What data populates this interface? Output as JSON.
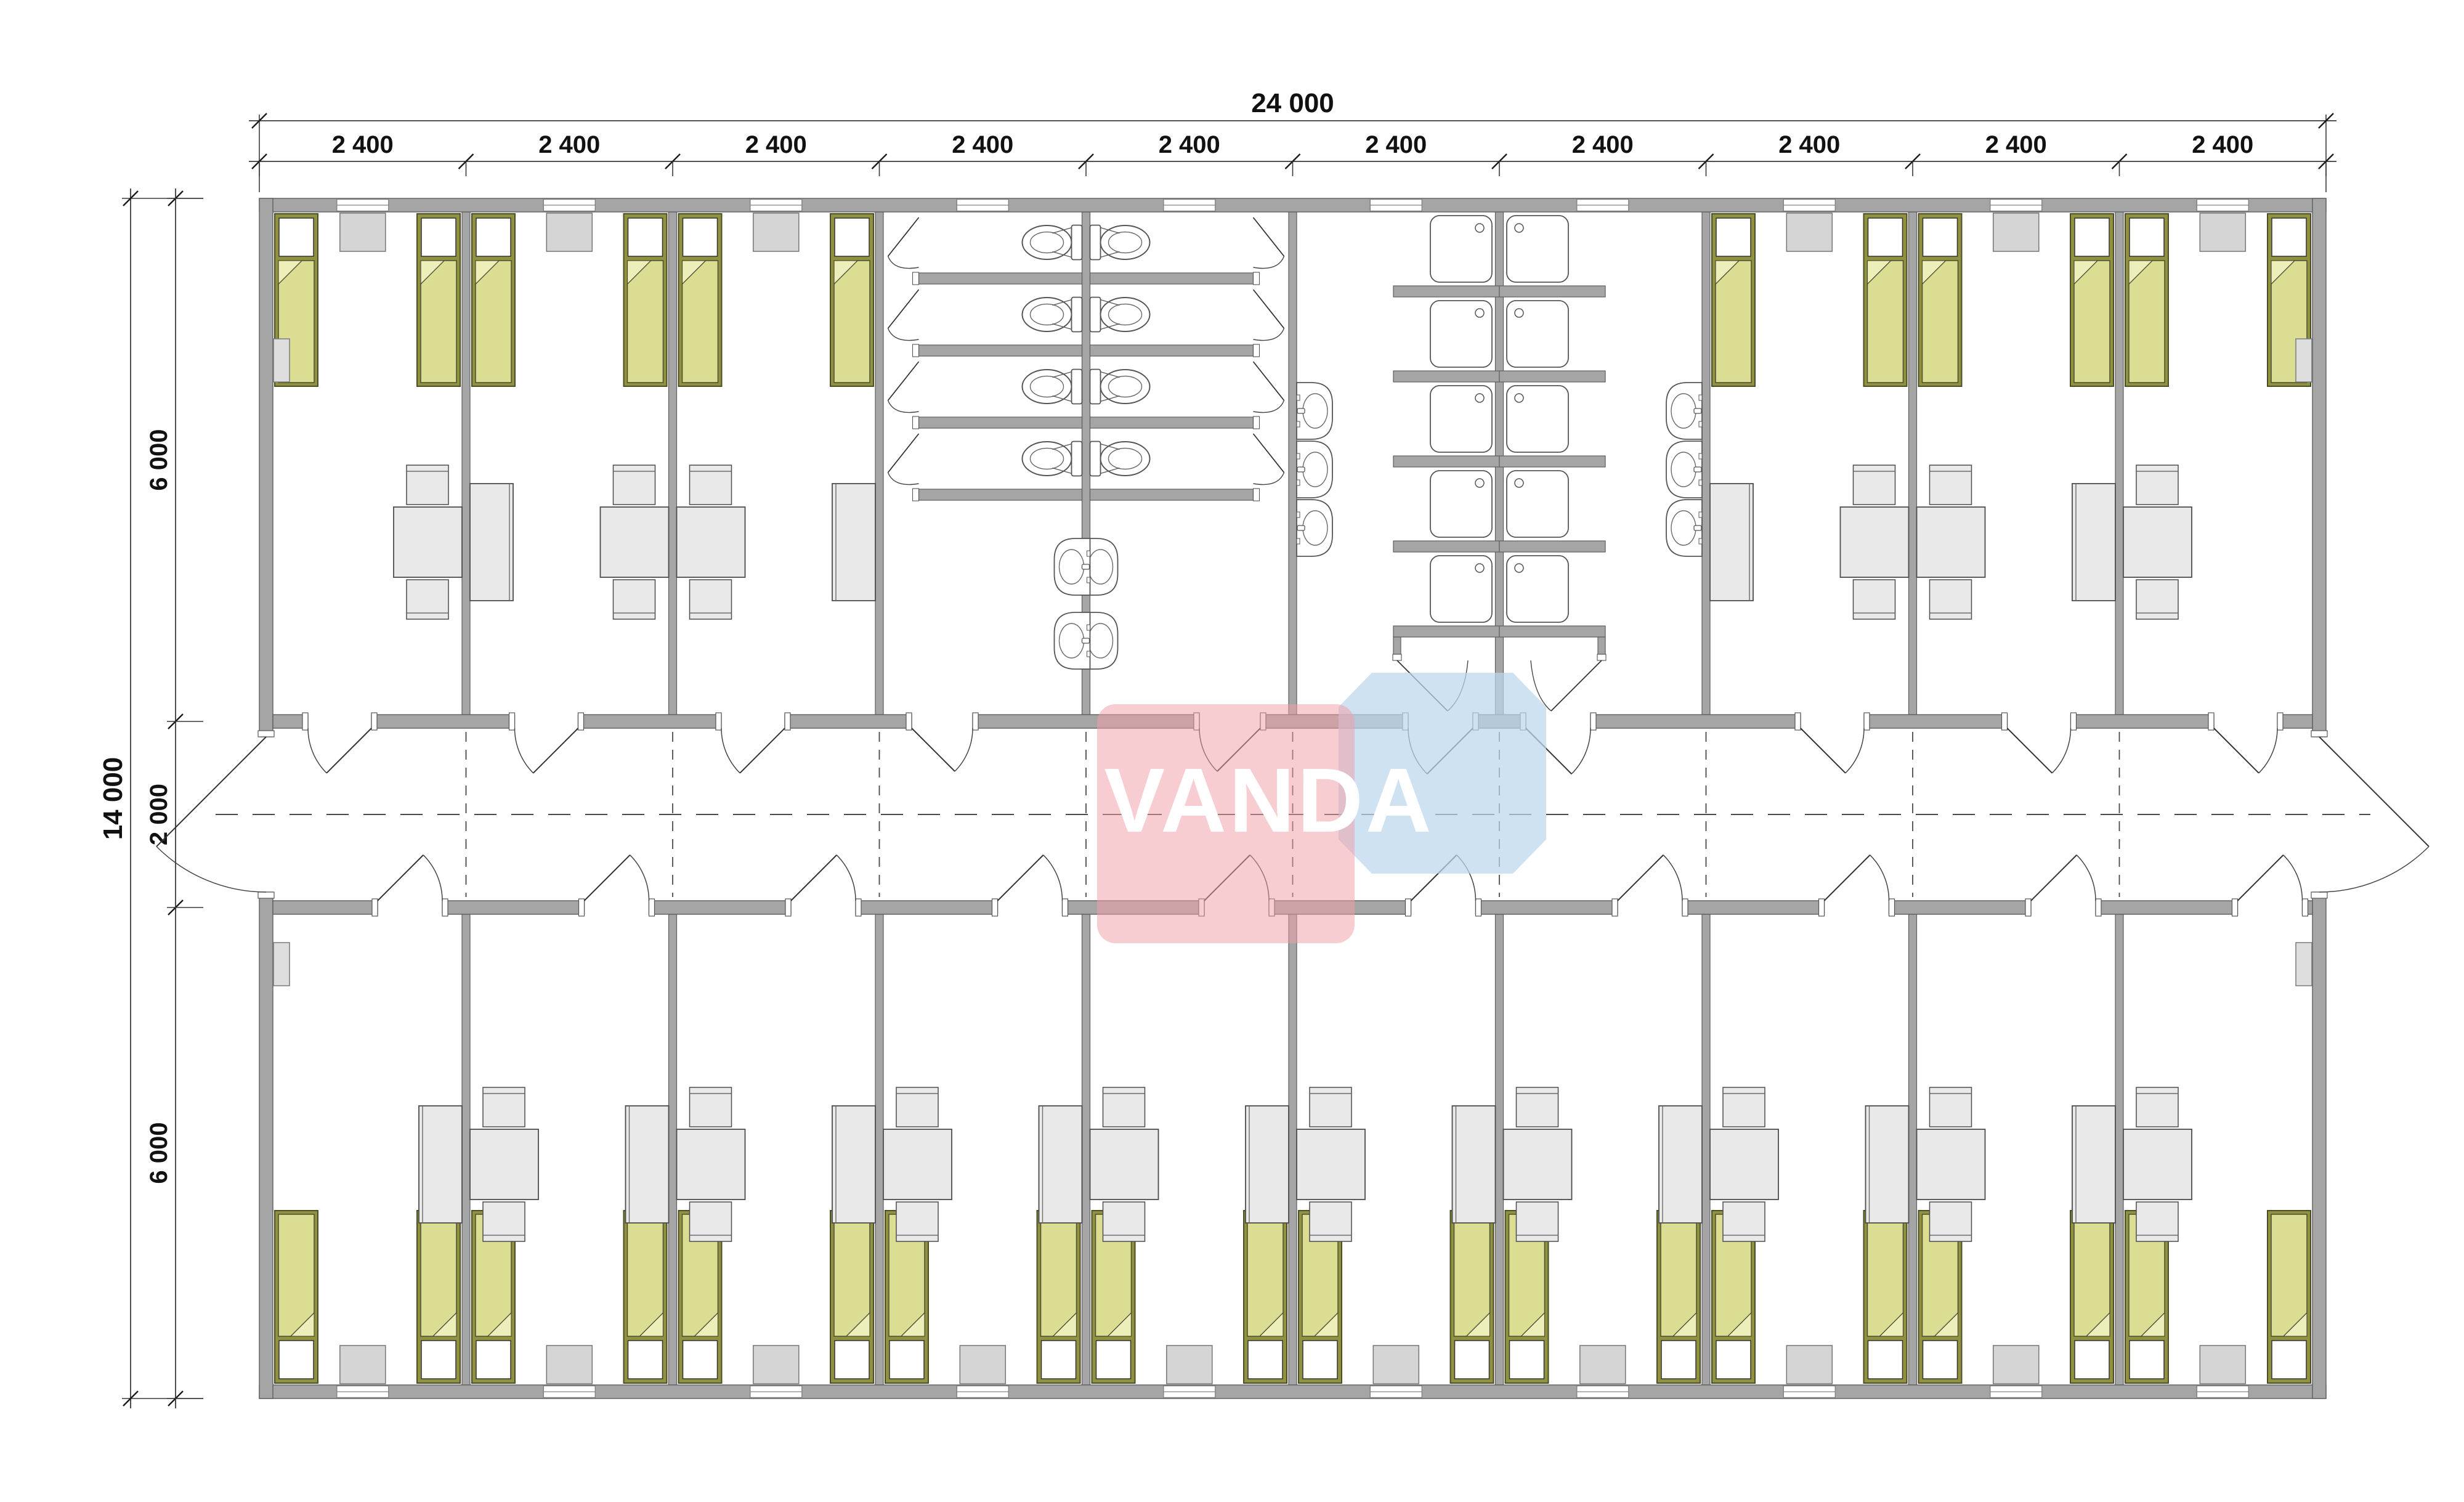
{
  "watermark": {
    "text": "VANDA"
  },
  "dimensions": {
    "top_total": "24 000",
    "top_modules": [
      "2 400",
      "2 400",
      "2 400",
      "2 400",
      "2 400",
      "2 400",
      "2 400",
      "2 400",
      "2 400",
      "2 400"
    ],
    "left_total": "14 000",
    "left_sections": [
      "6 000",
      "2 000",
      "6 000"
    ]
  },
  "colors": {
    "wall": "#a5a5a5",
    "wall_stroke": "#5e5e5e",
    "bed_frame": "#90923f",
    "bed_frame_stroke": "#4b4d2a",
    "blanket": "#dbde92",
    "blanket_fold": "#ecefb9",
    "pillow": "#ffffff",
    "furniture": "#e9e9e9",
    "furniture_stroke": "#4c4c4c",
    "nightstand": "#d5d5d5",
    "nightstand_stroke": "#767676",
    "fixture_stroke": "#555555",
    "line": "#3a3a3a",
    "dim_text": "#111111",
    "watermark_pink": "#ef9fa9",
    "watermark_blue": "#bdd7ec",
    "watermark_text": "#ffffff"
  },
  "inventory": {
    "modules": 10,
    "beds": 32,
    "toilet_stalls": 8,
    "shower_stalls": 10,
    "wash_basins": 10,
    "tables": 15,
    "chairs": 30,
    "wardrobes": 13,
    "nightstands": 16,
    "windows": 20,
    "corridor_doors": 20,
    "entrance_doors": 2
  }
}
